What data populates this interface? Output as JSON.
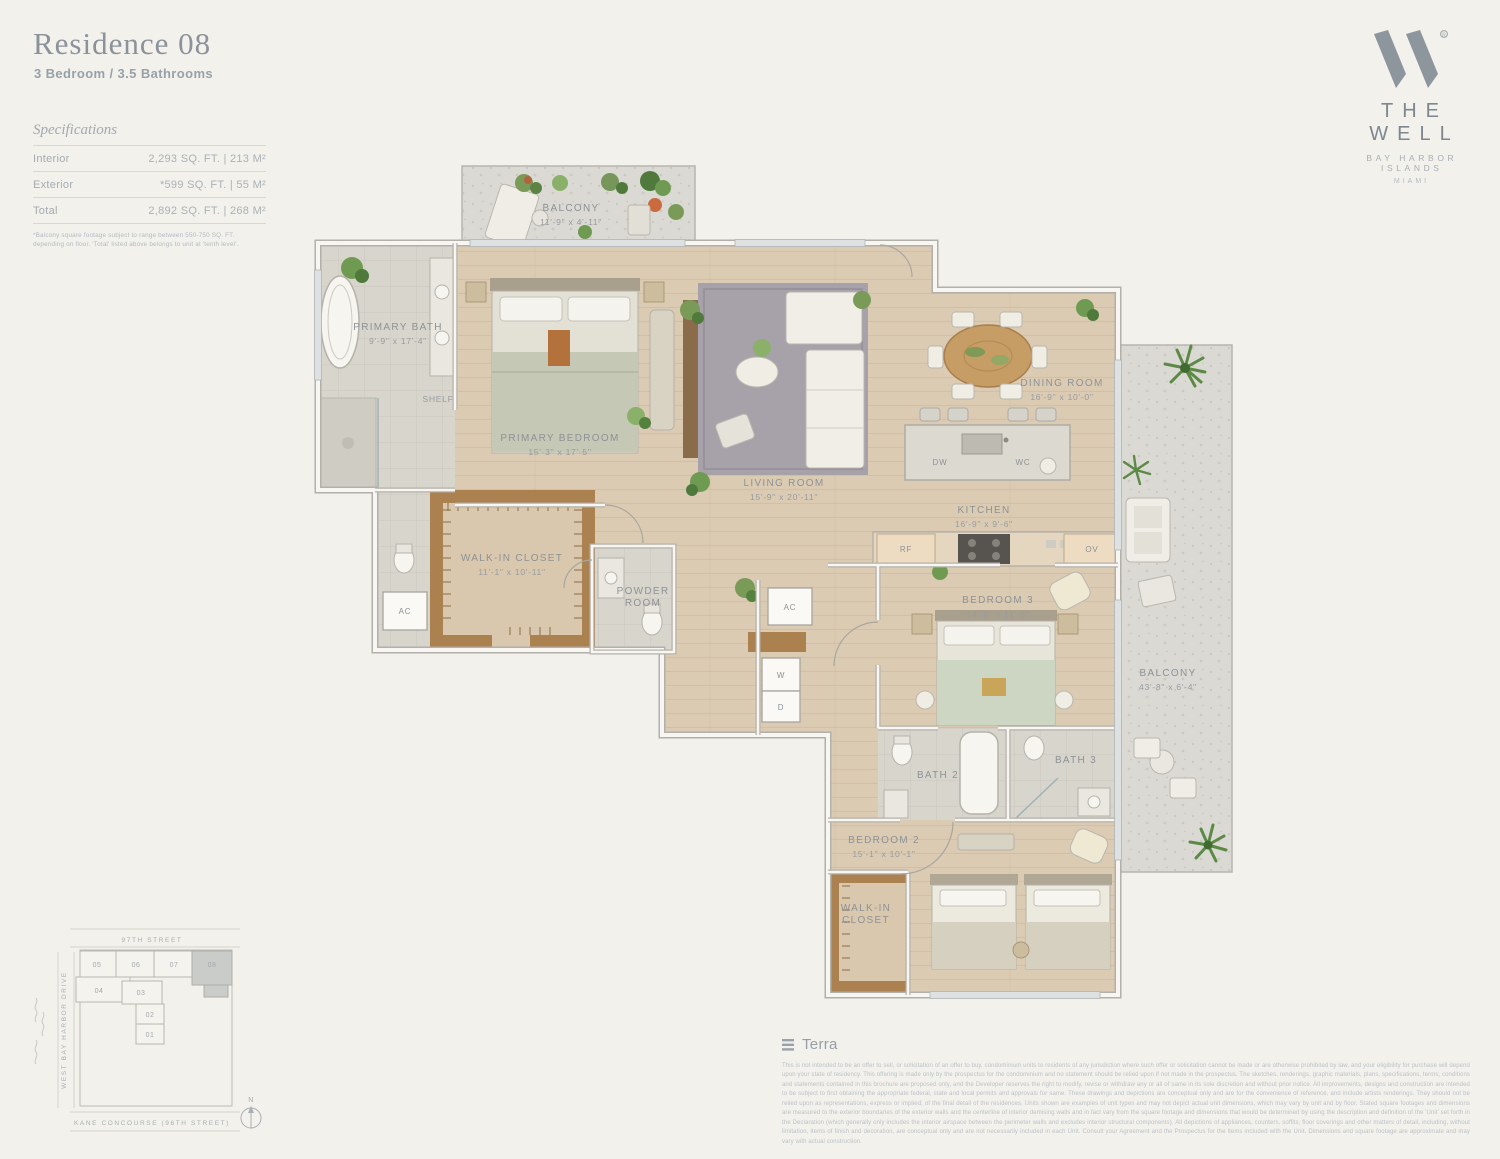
{
  "header": {
    "title": "Residence 08",
    "subtitle": "3 Bedroom / 3.5 Bathrooms"
  },
  "specs": {
    "heading": "Specifications",
    "rows": [
      {
        "label": "Interior",
        "value": "2,293 SQ. FT.  |  213 M²"
      },
      {
        "label": "Exterior",
        "value": "*599 SQ. FT.  |  55 M²"
      },
      {
        "label": "Total",
        "value": "2,892 SQ. FT.  |  268 M²"
      }
    ],
    "footnote": "*Balcony square footage subject to range between 550-750 SQ. FT. depending on floor. 'Total' listed above belongs to unit at 'tenth level'."
  },
  "brand": {
    "name": "THE WELL",
    "sub": "BAY HARBOR ISLANDS",
    "city": "MIAMI"
  },
  "floorplan": {
    "labels": {
      "balcony_top": {
        "name": "BALCONY",
        "dims": "11'-9\" x 4'-11\""
      },
      "primary_bath": {
        "name": "PRIMARY BATH",
        "dims": "9'-9\" x 17'-4\""
      },
      "shelf": "SHELF",
      "primary_bedroom": {
        "name": "PRIMARY BEDROOM",
        "dims": "15'-3\" x 17'-5\""
      },
      "living_room": {
        "name": "LIVING ROOM",
        "dims": "15'-9\" x 20'-11\""
      },
      "dining_room": {
        "name": "DINING ROOM",
        "dims": "16'-9\" x 10'-0\""
      },
      "kitchen": {
        "name": "KITCHEN",
        "dims": "16'-9\" x 9'-6\""
      },
      "walk_in_closet_1": {
        "name": "WALK-IN CLOSET",
        "dims": "11'-1\" x 10'-11\""
      },
      "powder_room_line1": "POWDER",
      "powder_room_line2": "ROOM",
      "bedroom_3": {
        "name": "BEDROOM 3",
        "dims": "14'-8\" x 11'-6\""
      },
      "balcony_right": {
        "name": "BALCONY",
        "dims": "43'-8\" x 6'-4\""
      },
      "bath_2": "BATH 2",
      "bath_3": "BATH 3",
      "bedroom_2": {
        "name": "BEDROOM 2",
        "dims": "15'-1\" x 10'-1\""
      },
      "walk_in_closet_2_line1": "WALK-IN",
      "walk_in_closet_2_line2": "CLOSET",
      "ac": "AC",
      "w": "W",
      "d": "D",
      "dw": "DW",
      "wc": "WC",
      "rf": "RF",
      "ov": "OV"
    }
  },
  "sitemap": {
    "street_top": "97TH STREET",
    "street_left": "WEST BAY HARBOR DRIVE",
    "street_bottom": "KANE CONCOURSE (96TH STREET)",
    "units": [
      "05",
      "06",
      "07",
      "08",
      "04",
      "03",
      "02",
      "01"
    ],
    "highlighted_unit": "08",
    "compass": "N"
  },
  "footer": {
    "brokerage": "Terra",
    "disclaimer": "This is not intended to be an offer to sell, or solicitation of an offer to buy, condominium units to residents of any jurisdiction where such offer or solicitation cannot be made or are otherwise prohibited by law, and your eligibility for purchase will depend upon your state of residency. This offering is made only by the prospectus for the condominium and no statement should be relied upon if not made in the prospectus. The sketches, renderings, graphic materials, plans, specifications, terms, conditions and statements contained in this brochure are proposed only, and the Developer reserves the right to modify, revise or withdraw any or all of same in its sole discretion and without prior notice. All improvements, designs and construction are intended to be subject to first obtaining the appropriate federal, state and local permits and approvals for same. These drawings and depictions are conceptual only and are for the convenience of reference, and include artists renderings. They should not be relied upon as representations, express or implied, of the final detail of the residences. Units shown are examples of unit types and may not depict actual unit dimensions, which may vary by unit and by floor. Stated square footages and dimensions are measured to the exterior boundaries of the exterior walls and the centerline of interior demising walls and in fact vary from the square footage and dimensions that would be determined by using the description and definition of the 'Unit' set forth in the Declaration (which generally only includes the interior airspace between the perimeter walls and excludes interior structural components). All depictions of appliances, counters, soffits, floor coverings and other matters of detail, including, without limitation, items of finish and decoration, are conceptual only and are not necessarily included in each Unit. Consult your Agreement and the Prospectus for the items included with the Unit. Dimensions and square footage are approximate and may vary with actual construction."
  }
}
